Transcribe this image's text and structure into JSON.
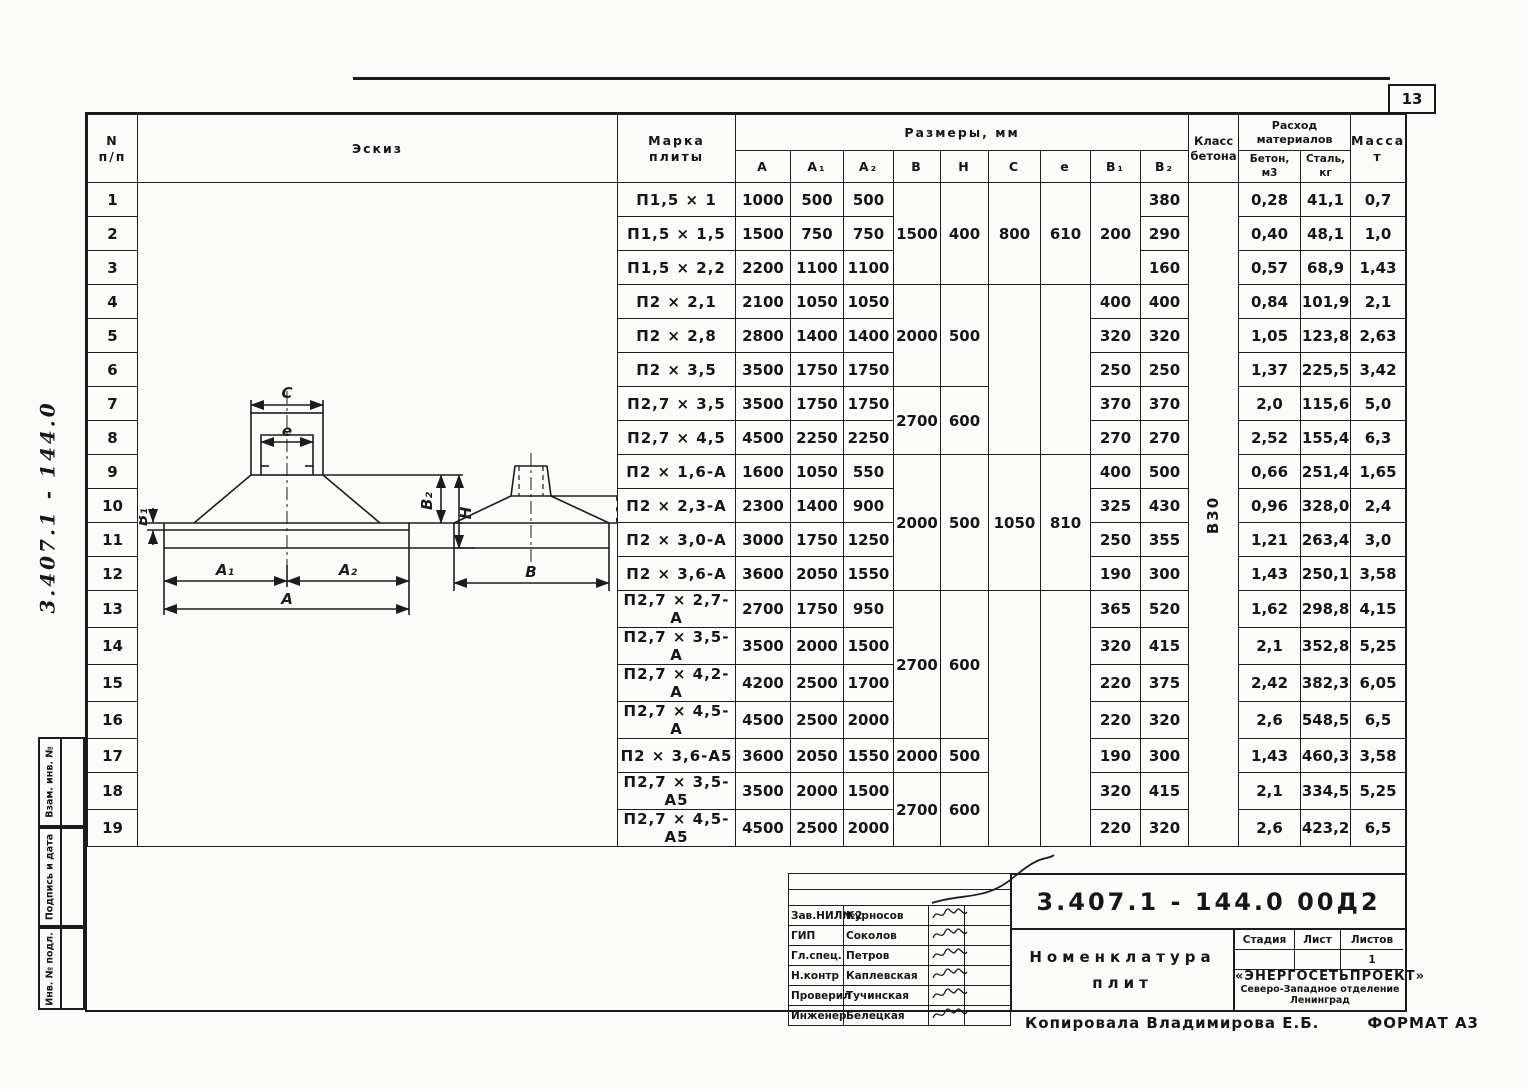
{
  "page": {
    "sheet_number": "13",
    "side_doc_number": "3.407.1 - 144.0",
    "copied_by": "Копировала  Владимирова Е.Б.",
    "format_note": "ФОРМАТ А3"
  },
  "sidebar": {
    "vzam": "Взам. инв. №",
    "podpis": "Подпись и дата",
    "inv": "Инв. № подл."
  },
  "table": {
    "header": {
      "col_n": "N",
      "col_n2": "п/п",
      "sketch": "Эскиз",
      "mark_1": "Марка",
      "mark_2": "плиты",
      "sizes": "Размеры,  мм",
      "class_1": "Класс",
      "class_2": "бетона",
      "consumption_1": "Расход",
      "consumption_2": "материалов",
      "concrete_1": "Бетон,",
      "concrete_2": "м3",
      "steel_1": "Сталь,",
      "steel_2": "кг",
      "mass_1": "Масса,",
      "mass_2": "т",
      "dims": [
        "A",
        "A₁",
        "A₂",
        "B",
        "H",
        "C",
        "e",
        "B₁",
        "B₂"
      ]
    },
    "concrete_class": "В30",
    "rows": [
      {
        "n": "1",
        "mark": "П1,5 × 1",
        "cells": [
          [
            "1000"
          ],
          [
            "500"
          ],
          [
            "500"
          ],
          [
            "1500",
            3
          ],
          [
            "400",
            3
          ],
          [
            "800",
            3
          ],
          [
            "610",
            3
          ],
          [
            "200",
            3
          ],
          [
            "380"
          ],
          [
            "В30",
            19,
            "vert"
          ],
          [
            "0,28"
          ],
          [
            "41,1"
          ],
          [
            "0,7"
          ]
        ]
      },
      {
        "n": "2",
        "mark": "П1,5 × 1,5",
        "cells": [
          [
            "1500"
          ],
          [
            "750"
          ],
          [
            "750"
          ],
          [
            "290"
          ],
          [
            "0,40"
          ],
          [
            "48,1"
          ],
          [
            "1,0"
          ]
        ]
      },
      {
        "n": "3",
        "mark": "П1,5 × 2,2",
        "cells": [
          [
            "2200"
          ],
          [
            "1100"
          ],
          [
            "1100"
          ],
          [
            "160"
          ],
          [
            "0,57"
          ],
          [
            "68,9"
          ],
          [
            "1,43"
          ]
        ]
      },
      {
        "n": "4",
        "mark": "П2 × 2,1",
        "cells": [
          [
            "2100"
          ],
          [
            "1050"
          ],
          [
            "1050"
          ],
          [
            "2000",
            3
          ],
          [
            "500",
            3
          ],
          [
            "",
            5
          ],
          [
            "",
            5
          ],
          [
            "400"
          ],
          [
            "400"
          ],
          [
            "0,84"
          ],
          [
            "101,9"
          ],
          [
            "2,1"
          ]
        ]
      },
      {
        "n": "5",
        "mark": "П2 × 2,8",
        "cells": [
          [
            "2800"
          ],
          [
            "1400"
          ],
          [
            "1400"
          ],
          [
            "320"
          ],
          [
            "320"
          ],
          [
            "1,05"
          ],
          [
            "123,8"
          ],
          [
            "2,63"
          ]
        ]
      },
      {
        "n": "6",
        "mark": "П2 × 3,5",
        "cells": [
          [
            "3500"
          ],
          [
            "1750"
          ],
          [
            "1750"
          ],
          [
            "250"
          ],
          [
            "250"
          ],
          [
            "1,37"
          ],
          [
            "225,5"
          ],
          [
            "3,42"
          ]
        ]
      },
      {
        "n": "7",
        "mark": "П2,7 × 3,5",
        "cells": [
          [
            "3500"
          ],
          [
            "1750"
          ],
          [
            "1750"
          ],
          [
            "2700",
            2
          ],
          [
            "600",
            2
          ],
          [
            "370"
          ],
          [
            "370"
          ],
          [
            "2,0"
          ],
          [
            "115,6"
          ],
          [
            "5,0"
          ]
        ]
      },
      {
        "n": "8",
        "mark": "П2,7 × 4,5",
        "cells": [
          [
            "4500"
          ],
          [
            "2250"
          ],
          [
            "2250"
          ],
          [
            "270"
          ],
          [
            "270"
          ],
          [
            "2,52"
          ],
          [
            "155,4"
          ],
          [
            "6,3"
          ]
        ]
      },
      {
        "n": "9",
        "mark": "П2 × 1,6-А",
        "cells": [
          [
            "1600"
          ],
          [
            "1050"
          ],
          [
            "550"
          ],
          [
            "2000",
            4
          ],
          [
            "500",
            4
          ],
          [
            "1050",
            4
          ],
          [
            "810",
            4
          ],
          [
            "400"
          ],
          [
            "500"
          ],
          [
            "0,66"
          ],
          [
            "251,4"
          ],
          [
            "1,65"
          ]
        ]
      },
      {
        "n": "10",
        "mark": "П2 × 2,3-А",
        "cells": [
          [
            "2300"
          ],
          [
            "1400"
          ],
          [
            "900"
          ],
          [
            "325"
          ],
          [
            "430"
          ],
          [
            "0,96"
          ],
          [
            "328,0"
          ],
          [
            "2,4"
          ]
        ]
      },
      {
        "n": "11",
        "mark": "П2 × 3,0-А",
        "cells": [
          [
            "3000"
          ],
          [
            "1750"
          ],
          [
            "1250"
          ],
          [
            "250"
          ],
          [
            "355"
          ],
          [
            "1,21"
          ],
          [
            "263,4"
          ],
          [
            "3,0"
          ]
        ]
      },
      {
        "n": "12",
        "mark": "П2 × 3,6-А",
        "cells": [
          [
            "3600"
          ],
          [
            "2050"
          ],
          [
            "1550"
          ],
          [
            "190"
          ],
          [
            "300"
          ],
          [
            "1,43"
          ],
          [
            "250,1"
          ],
          [
            "3,58"
          ]
        ]
      },
      {
        "n": "13",
        "mark": "П2,7 × 2,7-А",
        "cells": [
          [
            "2700"
          ],
          [
            "1750"
          ],
          [
            "950"
          ],
          [
            "2700",
            4
          ],
          [
            "600",
            4
          ],
          [
            "",
            7
          ],
          [
            "",
            7
          ],
          [
            "365"
          ],
          [
            "520"
          ],
          [
            "1,62"
          ],
          [
            "298,8"
          ],
          [
            "4,15"
          ]
        ]
      },
      {
        "n": "14",
        "mark": "П2,7 × 3,5-А",
        "cells": [
          [
            "3500"
          ],
          [
            "2000"
          ],
          [
            "1500"
          ],
          [
            "320"
          ],
          [
            "415"
          ],
          [
            "2,1"
          ],
          [
            "352,8"
          ],
          [
            "5,25"
          ]
        ]
      },
      {
        "n": "15",
        "mark": "П2,7 × 4,2-А",
        "cells": [
          [
            "4200"
          ],
          [
            "2500"
          ],
          [
            "1700"
          ],
          [
            "220"
          ],
          [
            "375"
          ],
          [
            "2,42"
          ],
          [
            "382,3"
          ],
          [
            "6,05"
          ]
        ]
      },
      {
        "n": "16",
        "mark": "П2,7 × 4,5-А",
        "cells": [
          [
            "4500"
          ],
          [
            "2500"
          ],
          [
            "2000"
          ],
          [
            "220"
          ],
          [
            "320"
          ],
          [
            "2,6"
          ],
          [
            "548,5"
          ],
          [
            "6,5"
          ]
        ]
      },
      {
        "n": "17",
        "mark": "П2 × 3,6-А5",
        "cells": [
          [
            "3600"
          ],
          [
            "2050"
          ],
          [
            "1550"
          ],
          [
            "2000"
          ],
          [
            "500"
          ],
          [
            "190"
          ],
          [
            "300"
          ],
          [
            "1,43"
          ],
          [
            "460,3"
          ],
          [
            "3,58"
          ]
        ]
      },
      {
        "n": "18",
        "mark": "П2,7 × 3,5-А5",
        "cells": [
          [
            "3500"
          ],
          [
            "2000"
          ],
          [
            "1500"
          ],
          [
            "2700",
            2
          ],
          [
            "600",
            2
          ],
          [
            "320"
          ],
          [
            "415"
          ],
          [
            "2,1"
          ],
          [
            "334,5"
          ],
          [
            "5,25"
          ]
        ]
      },
      {
        "n": "19",
        "mark": "П2,7 × 4,5-А5",
        "cells": [
          [
            "4500"
          ],
          [
            "2500"
          ],
          [
            "2000"
          ],
          [
            "220"
          ],
          [
            "320"
          ],
          [
            "2,6"
          ],
          [
            "423,2"
          ],
          [
            "6,5"
          ]
        ]
      }
    ]
  },
  "sketch": {
    "c": "C",
    "e": "e",
    "b1": "B₁",
    "b2": "B₂",
    "h": "H",
    "a1": "A₁",
    "a2": "A₂",
    "a": "A",
    "b": "B",
    "offset": "100"
  },
  "stamp": {
    "doc_number": "3.407.1 - 144.0    00Д2",
    "title_1": "Номенклатура",
    "title_2": "плит",
    "people": [
      {
        "role": "Зав.НИЛ№2",
        "name": "Курносов"
      },
      {
        "role": "ГИП",
        "name": "Соколов"
      },
      {
        "role": "Гл.спец.",
        "name": "Петров"
      },
      {
        "role": "Н.контр",
        "name": "Каплевская"
      },
      {
        "role": "Проверил",
        "name": "Тучинская"
      },
      {
        "role": "Инженер",
        "name": "Белецкая"
      }
    ],
    "stage_label": "Стадия",
    "sheet_label": "Лист",
    "sheets_label": "Листов",
    "sheets_value": "1",
    "org_1": "«ЭНЕРГОСЕТЬПРОЕКТ»",
    "org_2": "Северо-Западное отделение",
    "org_3": "Ленинград"
  }
}
